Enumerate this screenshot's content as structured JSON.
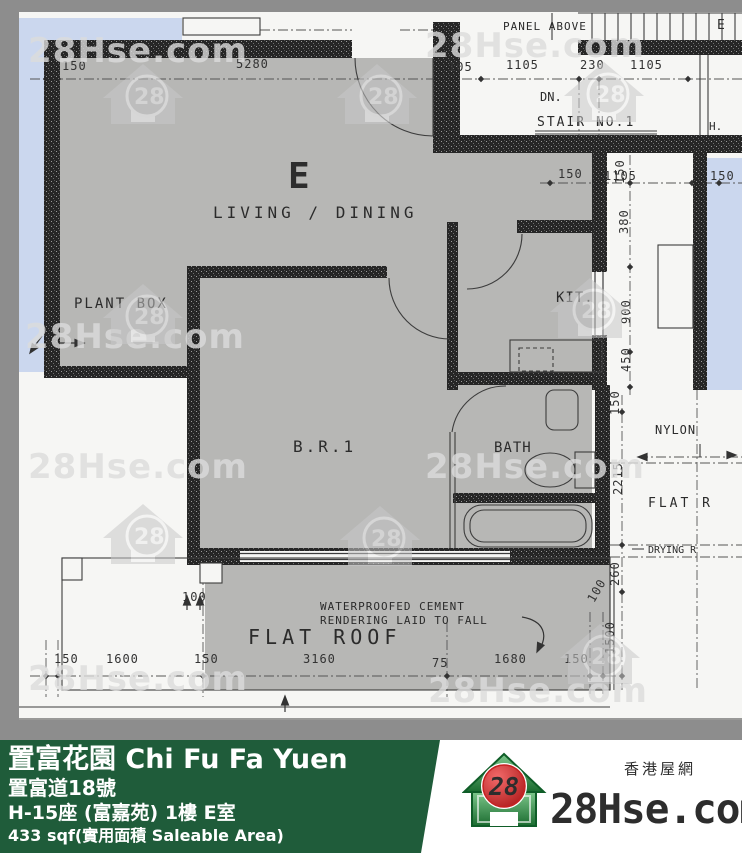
{
  "plan": {
    "unit_label": "E",
    "labels": {
      "living": "LIVING / DINING",
      "plant_box": "PLANT BOX",
      "bedroom": "B.R.1",
      "bath": "BATH",
      "kitchen": "KIT.",
      "flat_roof": "FLAT ROOF",
      "panel_above": "PANEL ABOVE",
      "dn": "DN.",
      "stair": "STAIR NO.1",
      "h_mark": "H.",
      "nylon": "NYLON",
      "flat_r_partial": "FLAT R",
      "drying_partial": "DRYING R",
      "e_partial": "E",
      "note_line1": "WATERPROOFED CEMENT",
      "note_line2": "RENDERING LAID TO FALL"
    },
    "dims": {
      "top": [
        "150",
        "5280",
        "105",
        "1105",
        "230",
        "1105"
      ],
      "stair_row": [
        "150",
        "1105",
        "150"
      ],
      "right_chain": [
        "150",
        "380",
        "900",
        "450",
        "150",
        "2215",
        "260",
        "100",
        "1500"
      ],
      "bottom": [
        "150",
        "1600",
        "150",
        "3160",
        "75",
        "1680",
        "150"
      ],
      "wall_dim": "100"
    },
    "colors": {
      "unit_accent": "#ee7c35",
      "glazing_blue": "#cbd7ee",
      "room_fill": "#b7b7b5"
    }
  },
  "watermark": {
    "text": "28Hse.com",
    "logo_number": "28"
  },
  "footer": {
    "estate": "置富花園 Chi Fu Fa Yuen",
    "address": "置富道18號",
    "unit": "H-15座 (富嘉苑) 1樓 E室",
    "area": "433 sqf(實用面積 Saleable Area)",
    "brand": {
      "site": "28Hse.com",
      "logo_number": "28",
      "tagline": "香港屋網"
    },
    "colors": {
      "bar_green": "#1f5c3a",
      "brand_green": "#1d8a3e",
      "logo_red": "#c8201f"
    }
  }
}
